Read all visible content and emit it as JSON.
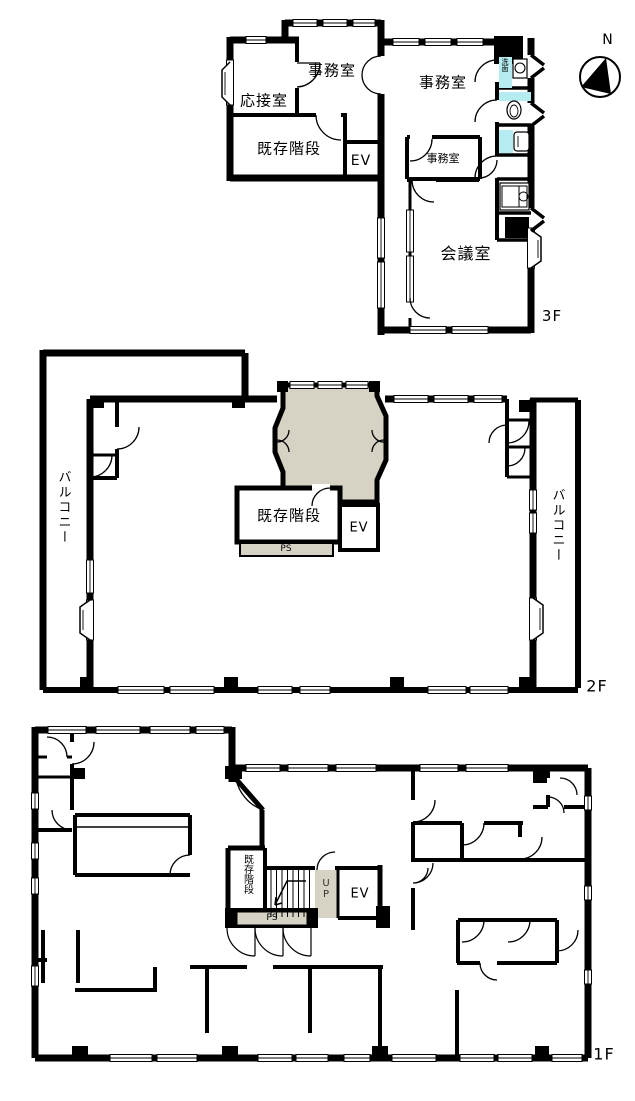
{
  "compass": {
    "label": "N"
  },
  "floor3": {
    "floor_label": "3F",
    "rooms": {
      "reception": "応接室",
      "office_top": "事務室",
      "office_main": "事務室",
      "office_small": "事務室",
      "meeting_room": "会議室",
      "existing_stairs": "既存階段",
      "elevator": "EV",
      "washbasin": "洗面"
    }
  },
  "floor2": {
    "floor_label": "2F",
    "rooms": {
      "balcony_left": "バルコニー",
      "balcony_right": "バルコニー",
      "existing_stairs": "既存階段",
      "elevator": "EV",
      "pipe_shaft": "PS"
    }
  },
  "floor1": {
    "floor_label": "1F",
    "rooms": {
      "existing_stairs": "既存階段",
      "stairs_up": "UP",
      "elevator": "EV",
      "pipe_shaft": "PS"
    }
  },
  "colors": {
    "wall": "#000000",
    "core_shading": "#d6d3c5",
    "sanitary_cyan": "#b4ecf1",
    "background": "#ffffff"
  }
}
